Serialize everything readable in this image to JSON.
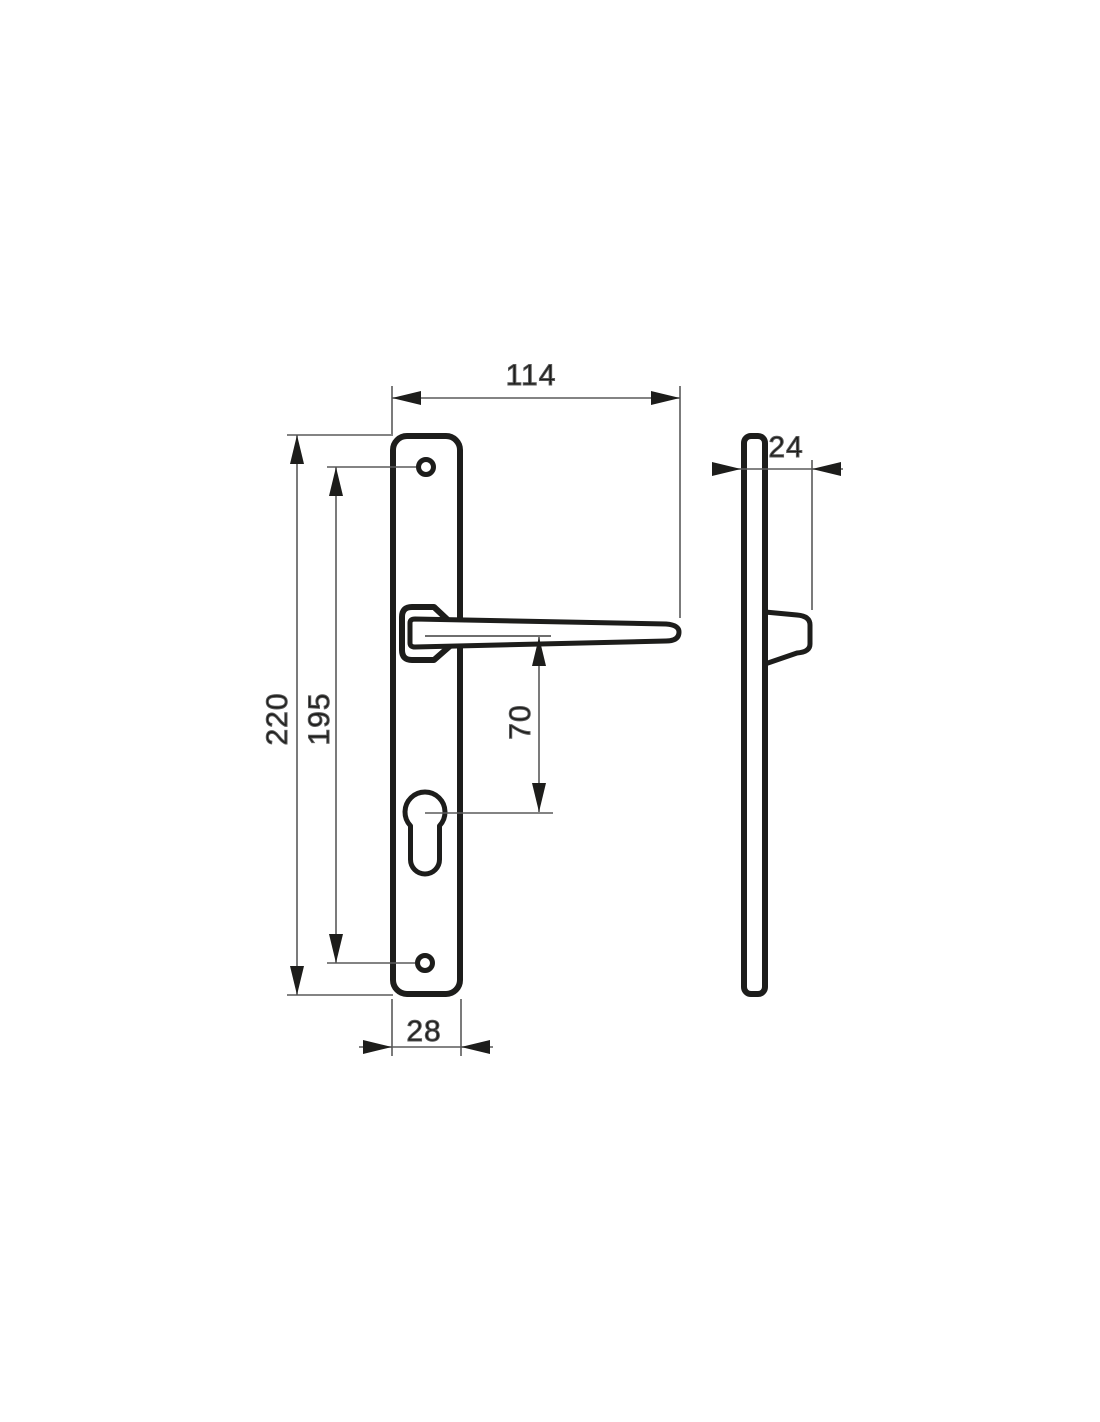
{
  "drawing": {
    "dimensions": {
      "width_top": "114",
      "overall_height": "220",
      "screw_hole_spacing": "195",
      "handle_to_cylinder": "70",
      "plate_width": "28",
      "projection_depth": "24"
    },
    "colors": {
      "background": "#ffffff",
      "outline": "#1d1d1b",
      "dimension_lines": "#5a5a5a"
    }
  }
}
